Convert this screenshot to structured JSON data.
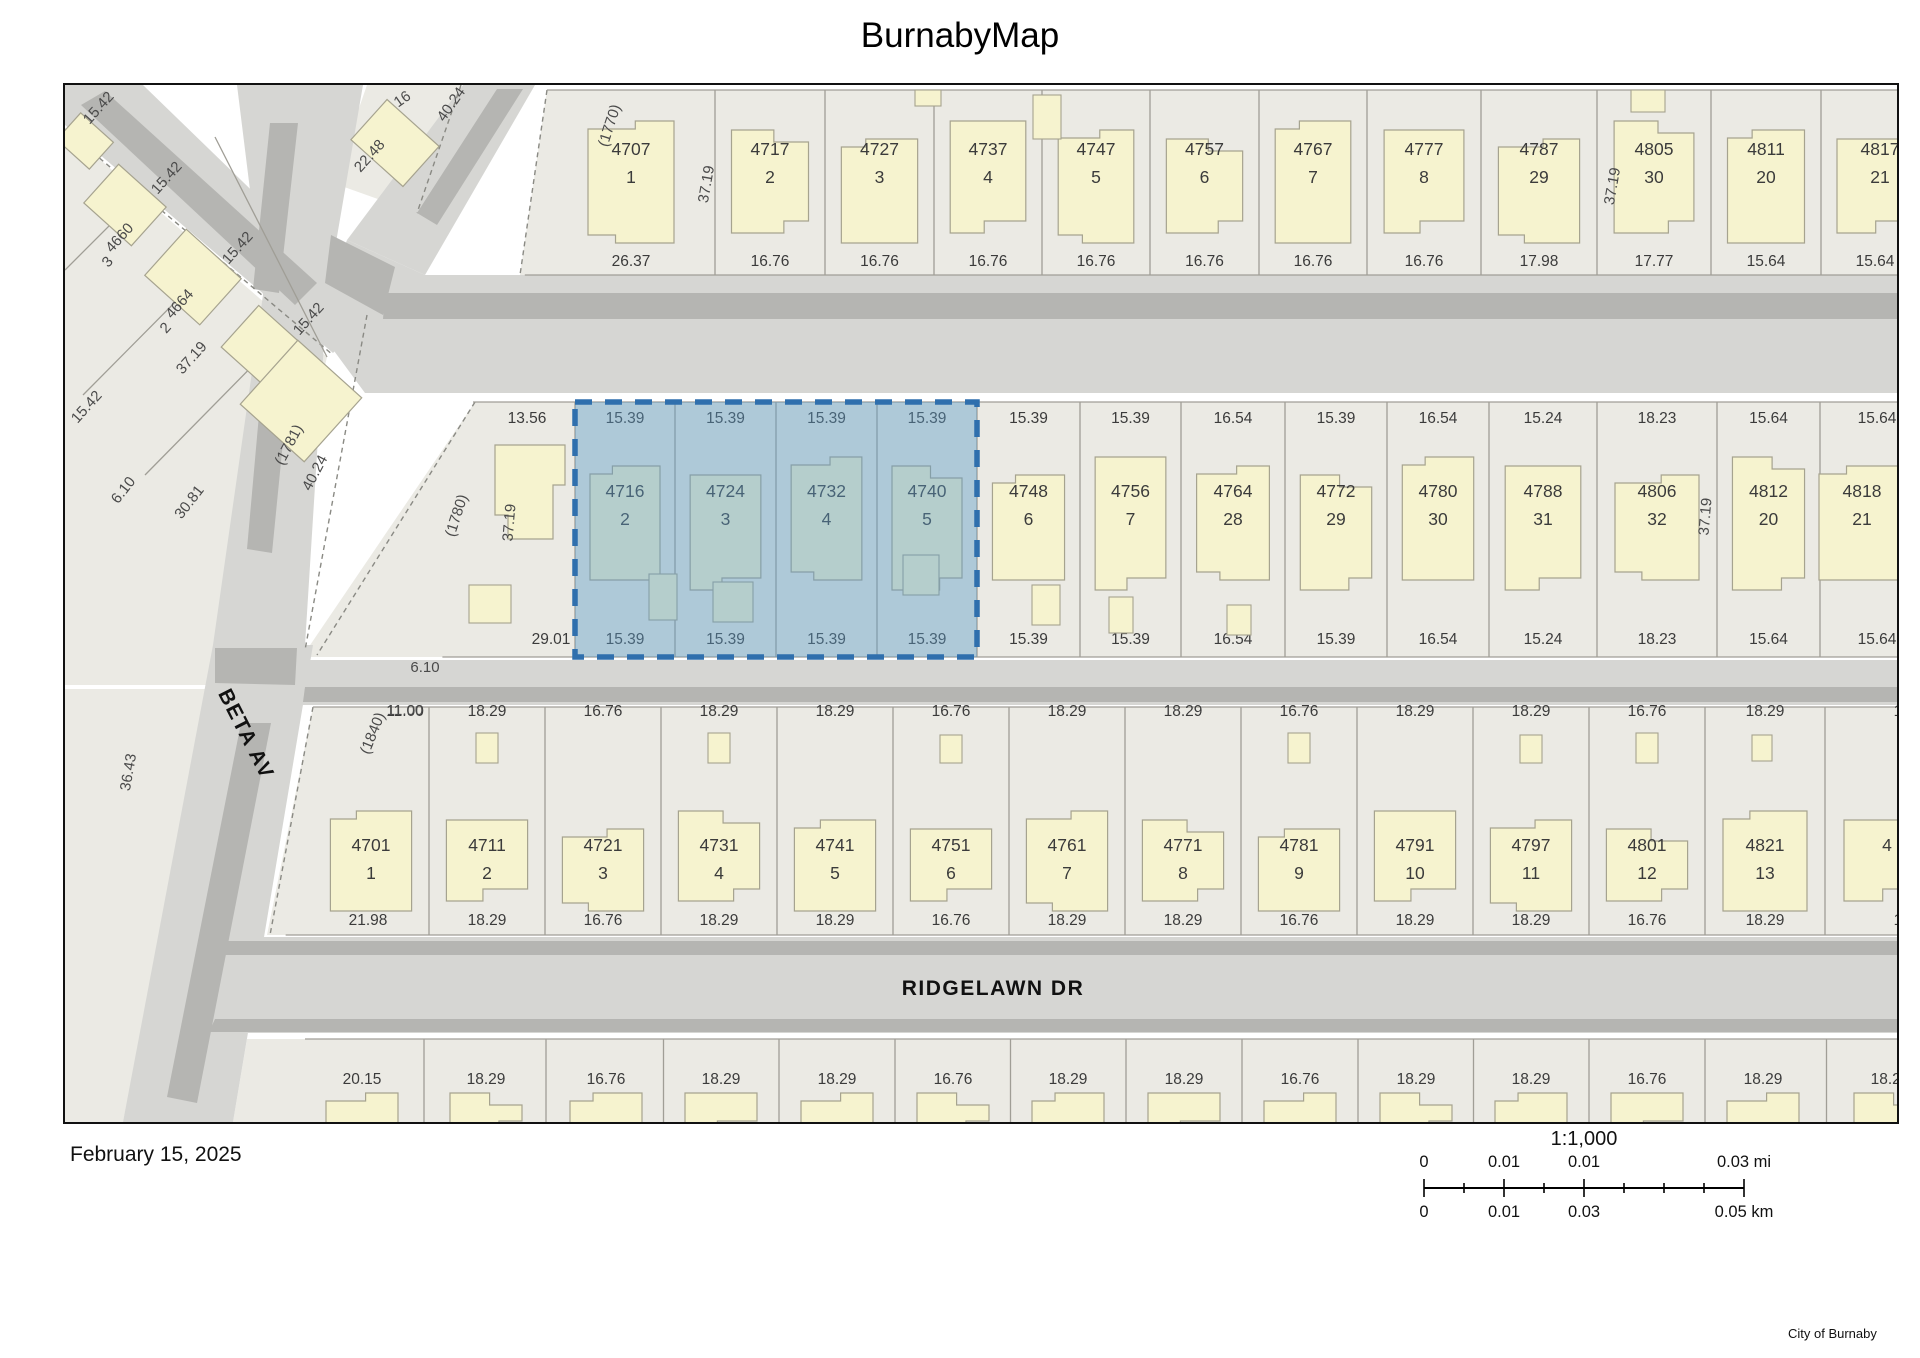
{
  "title": "BurnabyMap",
  "date": "February 15, 2025",
  "attribution": "City of Burnaby",
  "scalebar": {
    "ratio": "1:1,000",
    "mi_labels": [
      "0",
      "0.01",
      "0.01",
      "0.03"
    ],
    "mi_unit": "mi",
    "km_labels": [
      "0",
      "0.01",
      "0.03",
      "0.05"
    ],
    "km_unit": "km"
  },
  "streets": [
    {
      "name": "BETA AV",
      "x": 175,
      "y": 652,
      "rot": 63
    },
    {
      "name": "RIDGELAWN DR",
      "x": 928,
      "y": 910,
      "rot": 0
    }
  ],
  "selection": {
    "addresses": [
      "4716",
      "4724",
      "4732",
      "4740"
    ],
    "x": 510,
    "y": 317,
    "w": 402,
    "h": 255,
    "fill": "#5b9bc9",
    "stroke": "#2f6fad"
  },
  "colors": {
    "block": "#ebeae4",
    "road": "#d6d6d3",
    "stripe": "#b5b5b2",
    "line": "#a09e96",
    "building": "#f6f3cf",
    "building_stroke": "#a6a38f",
    "text": "#3b3b3b",
    "label": "#4a4a4a",
    "dash": "#8a8a84"
  },
  "rows": [
    {
      "name": "block-north",
      "y1": 5,
      "y2": 190,
      "addr_y": 70,
      "lot_y": 98,
      "dt_y": null,
      "db_y": 181,
      "by0": 36,
      "by1": 158,
      "bounds": [
        482,
        650,
        760,
        869,
        977,
        1085,
        1194,
        1302,
        1416,
        1532,
        1646,
        1756,
        1920
      ],
      "parcels": [
        {
          "addr": "4707",
          "lot": "1",
          "db": "26.37"
        },
        {
          "addr": "4717",
          "lot": "2",
          "db": "16.76"
        },
        {
          "addr": "4727",
          "lot": "3",
          "db": "16.76"
        },
        {
          "addr": "4737",
          "lot": "4",
          "db": "16.76"
        },
        {
          "addr": "4747",
          "lot": "5",
          "db": "16.76"
        },
        {
          "addr": "4757",
          "lot": "6",
          "db": "16.76"
        },
        {
          "addr": "4767",
          "lot": "7",
          "db": "16.76"
        },
        {
          "addr": "4777",
          "lot": "8",
          "db": "16.76"
        },
        {
          "addr": "4787",
          "lot": "29",
          "db": "17.98"
        },
        {
          "addr": "4805",
          "lot": "30",
          "db": "17.77"
        },
        {
          "addr": "4811",
          "lot": "20",
          "db": "15.64"
        },
        {
          "addr": "4817",
          "lot": "21",
          "db": "15.64",
          "ax": 1815,
          "dbx": 1810
        }
      ]
    },
    {
      "name": "block-middle",
      "y1": 317,
      "y2": 572,
      "addr_y": 412,
      "lot_y": 440,
      "dt_y": 338,
      "db_y": 559,
      "by0": 372,
      "by1": 505,
      "bounds": [
        408,
        510,
        610,
        711,
        812,
        912,
        1015,
        1116,
        1220,
        1322,
        1424,
        1532,
        1652,
        1755,
        1920
      ],
      "parcels": [
        {
          "addr": "",
          "lot": "",
          "dt": "13.56",
          "db": "29.01",
          "dtx": 462,
          "dbx": 486
        },
        {
          "addr": "4716",
          "lot": "2",
          "dt": "15.39",
          "db": "15.39",
          "sel": true
        },
        {
          "addr": "4724",
          "lot": "3",
          "dt": "15.39",
          "db": "15.39",
          "sel": true
        },
        {
          "addr": "4732",
          "lot": "4",
          "dt": "15.39",
          "db": "15.39",
          "sel": true
        },
        {
          "addr": "4740",
          "lot": "5",
          "dt": "15.39",
          "db": "15.39",
          "sel": true
        },
        {
          "addr": "4748",
          "lot": "6",
          "dt": "15.39",
          "db": "15.39"
        },
        {
          "addr": "4756",
          "lot": "7",
          "dt": "15.39",
          "db": "15.39"
        },
        {
          "addr": "4764",
          "lot": "28",
          "dt": "16.54",
          "db": "16.54"
        },
        {
          "addr": "4772",
          "lot": "29",
          "dt": "15.39",
          "db": "15.39"
        },
        {
          "addr": "4780",
          "lot": "30",
          "dt": "16.54",
          "db": "16.54"
        },
        {
          "addr": "4788",
          "lot": "31",
          "dt": "15.24",
          "db": "15.24"
        },
        {
          "addr": "4806",
          "lot": "32",
          "dt": "18.23",
          "db": "18.23"
        },
        {
          "addr": "4812",
          "lot": "20",
          "dt": "15.64",
          "db": "15.64"
        },
        {
          "addr": "4818",
          "lot": "21",
          "dt": "15.64",
          "db": "15.64",
          "ax": 1797,
          "dtx": 1812,
          "dbx": 1812
        }
      ]
    },
    {
      "name": "block-south",
      "y1": 622,
      "y2": 850,
      "addr_y": 766,
      "lot_y": 794,
      "dt_y": 631,
      "db_y": 840,
      "by0": 726,
      "by1": 826,
      "bounds": [
        248,
        364,
        480,
        596,
        712,
        828,
        944,
        1060,
        1176,
        1292,
        1408,
        1524,
        1640,
        1760,
        1930
      ],
      "parcels": [
        {
          "addr": "4701",
          "lot": "1",
          "dt": "11.00",
          "db": "21.98",
          "dtx": 340,
          "dbx": 303
        },
        {
          "addr": "4711",
          "lot": "2",
          "dt": "18.29",
          "db": "18.29"
        },
        {
          "addr": "4721",
          "lot": "3",
          "dt": "16.76",
          "db": "16.76"
        },
        {
          "addr": "4731",
          "lot": "4",
          "dt": "18.29",
          "db": "18.29"
        },
        {
          "addr": "4741",
          "lot": "5",
          "dt": "18.29",
          "db": "18.29"
        },
        {
          "addr": "4751",
          "lot": "6",
          "dt": "16.76",
          "db": "16.76"
        },
        {
          "addr": "4761",
          "lot": "7",
          "dt": "18.29",
          "db": "18.29"
        },
        {
          "addr": "4771",
          "lot": "8",
          "dt": "18.29",
          "db": "18.29"
        },
        {
          "addr": "4781",
          "lot": "9",
          "dt": "16.76",
          "db": "16.76"
        },
        {
          "addr": "4791",
          "lot": "10",
          "dt": "18.29",
          "db": "18.29"
        },
        {
          "addr": "4797",
          "lot": "11",
          "dt": "18.29",
          "db": "18.29"
        },
        {
          "addr": "4801",
          "lot": "12",
          "dt": "16.76",
          "db": "16.76"
        },
        {
          "addr": "4821",
          "lot": "13",
          "dt": "18.29",
          "db": "18.29"
        },
        {
          "addr": "4",
          "lot": "",
          "dt": "18.29",
          "db": "18.29",
          "ax": 1822,
          "dtx": 1848,
          "dbx": 1848
        }
      ]
    }
  ],
  "far_south_row": {
    "name": "block-farsouth",
    "y1": 954,
    "y2": 1037,
    "dt_y": 999,
    "centers": [
      297,
      421,
      541,
      656,
      772,
      888,
      1003,
      1119,
      1235,
      1351,
      1466,
      1582,
      1698,
      1825
    ],
    "dims": [
      "20.15",
      "18.29",
      "16.76",
      "18.29",
      "18.29",
      "16.76",
      "18.29",
      "18.29",
      "16.76",
      "18.29",
      "18.29",
      "16.76",
      "18.29",
      "18.29"
    ]
  },
  "map_labels": [
    {
      "t": "15.42",
      "x": 37,
      "y": 26,
      "r": -48
    },
    {
      "t": "15.42",
      "x": 105,
      "y": 96,
      "r": -48
    },
    {
      "t": "15.42",
      "x": 176,
      "y": 166,
      "r": -48
    },
    {
      "t": "15.42",
      "x": 247,
      "y": 237,
      "r": -48
    },
    {
      "t": "15.42",
      "x": 25,
      "y": 325,
      "r": -48
    },
    {
      "t": "4660",
      "x": 58,
      "y": 156,
      "r": -48
    },
    {
      "t": "3",
      "x": 46,
      "y": 180,
      "r": -48
    },
    {
      "t": "4664",
      "x": 118,
      "y": 222,
      "r": -48
    },
    {
      "t": "2",
      "x": 104,
      "y": 246,
      "r": -48
    },
    {
      "t": "37.19",
      "x": 130,
      "y": 276,
      "r": -48
    },
    {
      "t": "22.48",
      "x": 308,
      "y": 74,
      "r": -48
    },
    {
      "t": "16",
      "x": 340,
      "y": 18,
      "r": -35
    },
    {
      "t": "40.24",
      "x": 390,
      "y": 22,
      "r": -55
    },
    {
      "t": "(1781)",
      "x": 228,
      "y": 362,
      "r": -62
    },
    {
      "t": "40.24",
      "x": 254,
      "y": 390,
      "r": -62
    },
    {
      "t": "30.81",
      "x": 128,
      "y": 420,
      "r": -52
    },
    {
      "t": "6.10",
      "x": 62,
      "y": 408,
      "r": -52
    },
    {
      "t": "36.43",
      "x": 68,
      "y": 688,
      "r": -80
    },
    {
      "t": "(1840)",
      "x": 312,
      "y": 650,
      "r": -68
    },
    {
      "t": "6.10",
      "x": 360,
      "y": 587,
      "r": 0
    },
    {
      "t": "(1780)",
      "x": 396,
      "y": 432,
      "r": -72
    },
    {
      "t": "(1770)",
      "x": 549,
      "y": 42,
      "r": -72
    },
    {
      "t": "37.19",
      "x": 449,
      "y": 438,
      "r": -85
    },
    {
      "t": "37.19",
      "x": 1645,
      "y": 432,
      "r": -85
    },
    {
      "t": "37.19",
      "x": 646,
      "y": 100,
      "r": -80
    },
    {
      "t": "37.19",
      "x": 1552,
      "y": 102,
      "r": -80
    },
    {
      "t": "11.00",
      "x": 340,
      "y": 630,
      "r": 0
    }
  ]
}
